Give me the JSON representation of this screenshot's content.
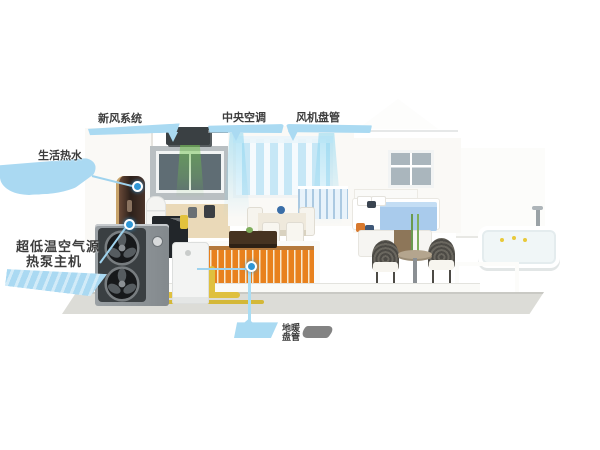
{
  "illustration": {
    "title": "air-source heat pump whole-house heating, cooling and hot-water system cutaway",
    "callouts": {
      "fresh_air": {
        "label": "新风系统"
      },
      "central_ac": {
        "label": "中央空调"
      },
      "fan_coil": {
        "label": "风机盘管"
      },
      "hot_water": {
        "label": "生活热水"
      },
      "heat_pump": {
        "line1": "超低温空气源",
        "line2": "热泵主机"
      },
      "floor_heating": {
        "line1": "地暖",
        "line2": "盘管"
      }
    },
    "colors": {
      "callout_blue": "#aadaf2",
      "marker_blue": "#2f96d5",
      "text_dark": "#3c3c3c",
      "floor_heating_orange": "#e8811d",
      "pipe_yellow": "#dfc03e",
      "fresh_air_green": "#6ec24a",
      "ac_air_cyan": "#7fd2ef"
    }
  }
}
